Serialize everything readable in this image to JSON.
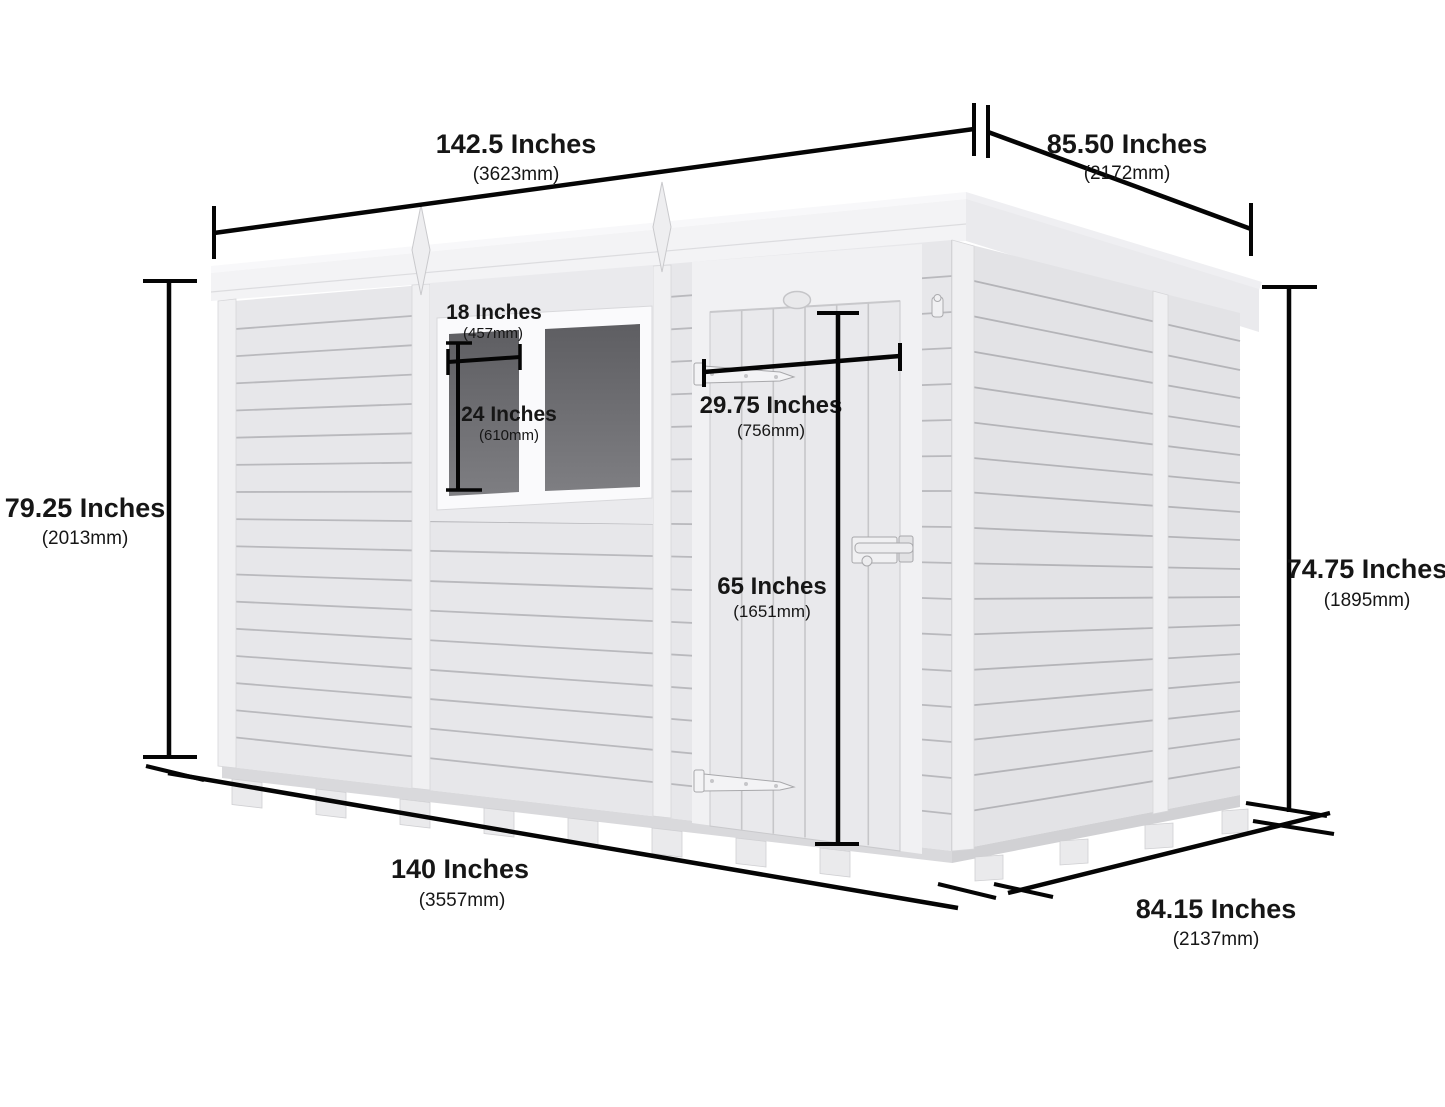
{
  "diagram": {
    "subject": "pent-shed-dimension-diagram",
    "colors": {
      "background": "#ffffff",
      "dimension_line": "#050505",
      "shed_front": "#e7e7ea",
      "shed_side": "#e3e3e6",
      "trim": "#f0f0f2",
      "glass": "#6a6a6e"
    },
    "dims": {
      "roof_width": {
        "inches": "142.5 Inches",
        "mm": "(3623mm)"
      },
      "roof_depth": {
        "inches": "85.50 Inches",
        "mm": "(2172mm)"
      },
      "front_height": {
        "inches": "79.25 Inches",
        "mm": "(2013mm)"
      },
      "rear_height": {
        "inches": "74.75 Inches",
        "mm": "(1895mm)"
      },
      "base_width": {
        "inches": "140 Inches",
        "mm": "(3557mm)"
      },
      "base_depth": {
        "inches": "84.15 Inches",
        "mm": "(2137mm)"
      },
      "window_width": {
        "inches": "18 Inches",
        "mm": "(457mm)"
      },
      "window_height": {
        "inches": "24 Inches",
        "mm": "(610mm)"
      },
      "door_width": {
        "inches": "29.75 Inches",
        "mm": "(756mm)"
      },
      "door_height": {
        "inches": "65 Inches",
        "mm": "(1651mm)"
      }
    }
  }
}
